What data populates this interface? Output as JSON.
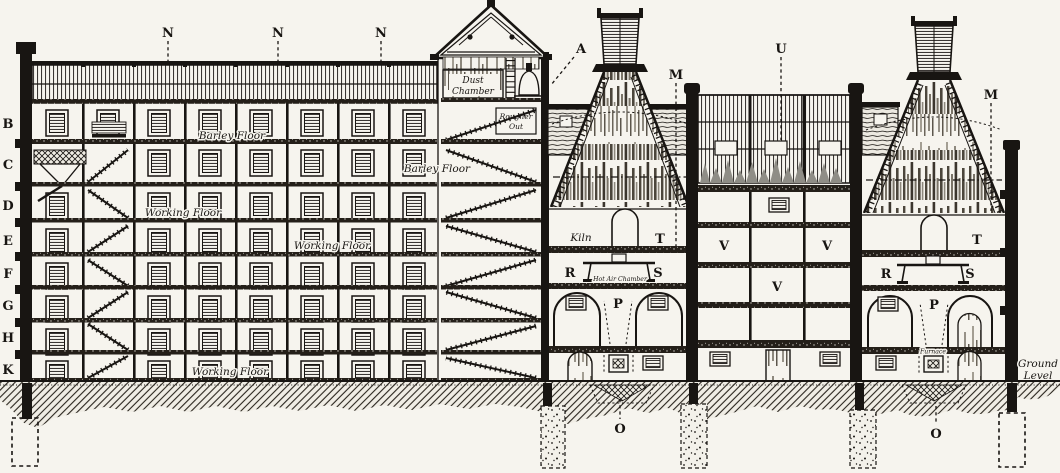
{
  "figure": {
    "kind": "sectional elevation engraving",
    "subject": "Cross-section of a maltings: multi-storey malthouse, dust chamber tower, two kilns with cowls and malt store between",
    "paper_color": "#f6f4ee",
    "ink_color": "#181512"
  },
  "reference_letters": {
    "n1": "N",
    "n2": "N",
    "n3": "N",
    "a": "A",
    "m1": "M",
    "u": "U",
    "m2": "M",
    "b": "B",
    "c": "C",
    "d": "D",
    "e": "E",
    "f": "F",
    "g": "G",
    "h": "H",
    "k": "K",
    "t1": "T",
    "t2": "T",
    "r1": "R",
    "s1": "S",
    "r2": "R",
    "s2": "S",
    "p1": "P",
    "p2": "P",
    "v1": "V",
    "v2": "V",
    "v3": "V",
    "o1": "O",
    "o2": "O"
  },
  "room_labels": {
    "dust_chamber_1": "Dust",
    "dust_chamber_2": "Chamber",
    "rougher_out_1": "Rougher",
    "rougher_out_2": "Out",
    "barley_floor_upper": "Barley Floor",
    "barley_floor_lower": "Barley Floor",
    "working_floor_upper": "Working Floor",
    "working_floor_middle": "Working Floor",
    "working_floor_bottom": "Working Floor",
    "kiln": "Kiln",
    "hot_air_chamber": "Hot Air Chamber",
    "furnace": "Furnace",
    "ground_level_1": "Ground",
    "ground_level_2": "Level"
  }
}
